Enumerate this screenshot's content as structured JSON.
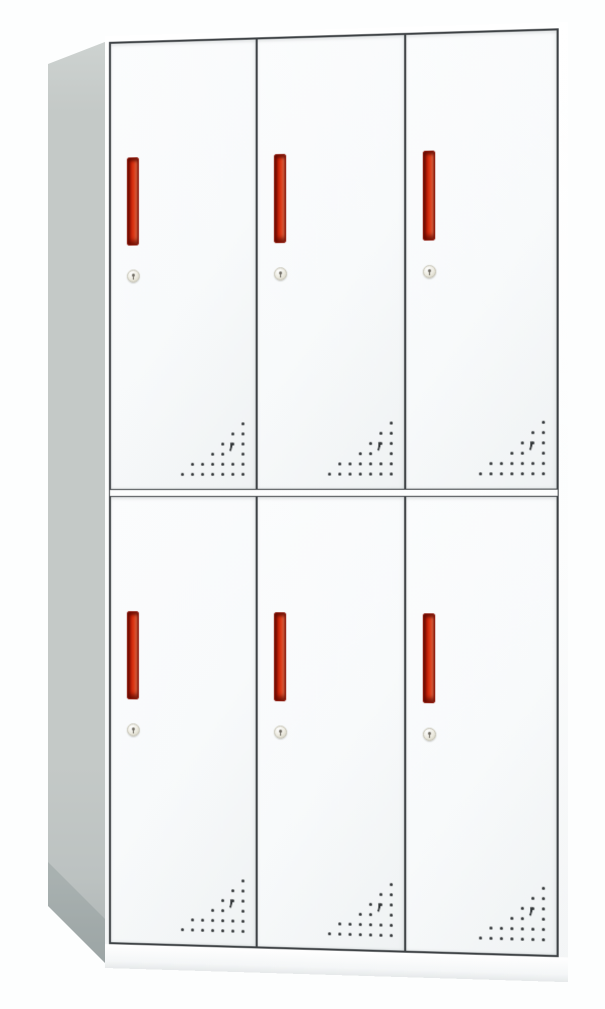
{
  "scene": {
    "background_color": "#fdfefe"
  },
  "cabinet": {
    "rows": 2,
    "columns": 3,
    "door_count": 6,
    "doors": [
      {
        "id": "door-1",
        "row": 1,
        "col": 1
      },
      {
        "id": "door-2",
        "row": 1,
        "col": 2
      },
      {
        "id": "door-3",
        "row": 1,
        "col": 3
      },
      {
        "id": "door-4",
        "row": 2,
        "col": 1
      },
      {
        "id": "door-5",
        "row": 2,
        "col": 2
      },
      {
        "id": "door-6",
        "row": 2,
        "col": 3
      }
    ],
    "door_features": [
      "vertical-handle",
      "key-lock",
      "ventilation-holes"
    ],
    "colors": {
      "background": "#fdfefe",
      "body": "#fcfdfd",
      "door_fill": "#f8fafb",
      "frame_outline": "#3d4144",
      "side_panel": "#c4c9c7",
      "side_panel_highlight": "#ced3d1",
      "side_panel_shadow": "#a9b0b0",
      "handle_dark": "#9e1406",
      "handle_mid": "#df3a16",
      "handle_light": "#f0714a",
      "handle_border": "#8a1508",
      "lock_face": "#eceadf",
      "lock_border": "#c2bfb0",
      "keyhole": "#6b675e",
      "vent_dot": "#2f3335"
    },
    "vent_pattern": {
      "grid_spacing_px": 10,
      "dot_size_px": 3,
      "rows": [
        [
          7
        ],
        [
          6,
          7
        ],
        [
          5,
          6,
          7
        ],
        [
          4,
          5,
          7
        ],
        [
          2,
          3,
          4,
          5,
          6,
          7
        ],
        [
          1,
          2,
          3,
          4,
          5,
          6,
          7
        ]
      ],
      "crescent": {
        "col": 5.6,
        "row": 2.4
      }
    }
  }
}
